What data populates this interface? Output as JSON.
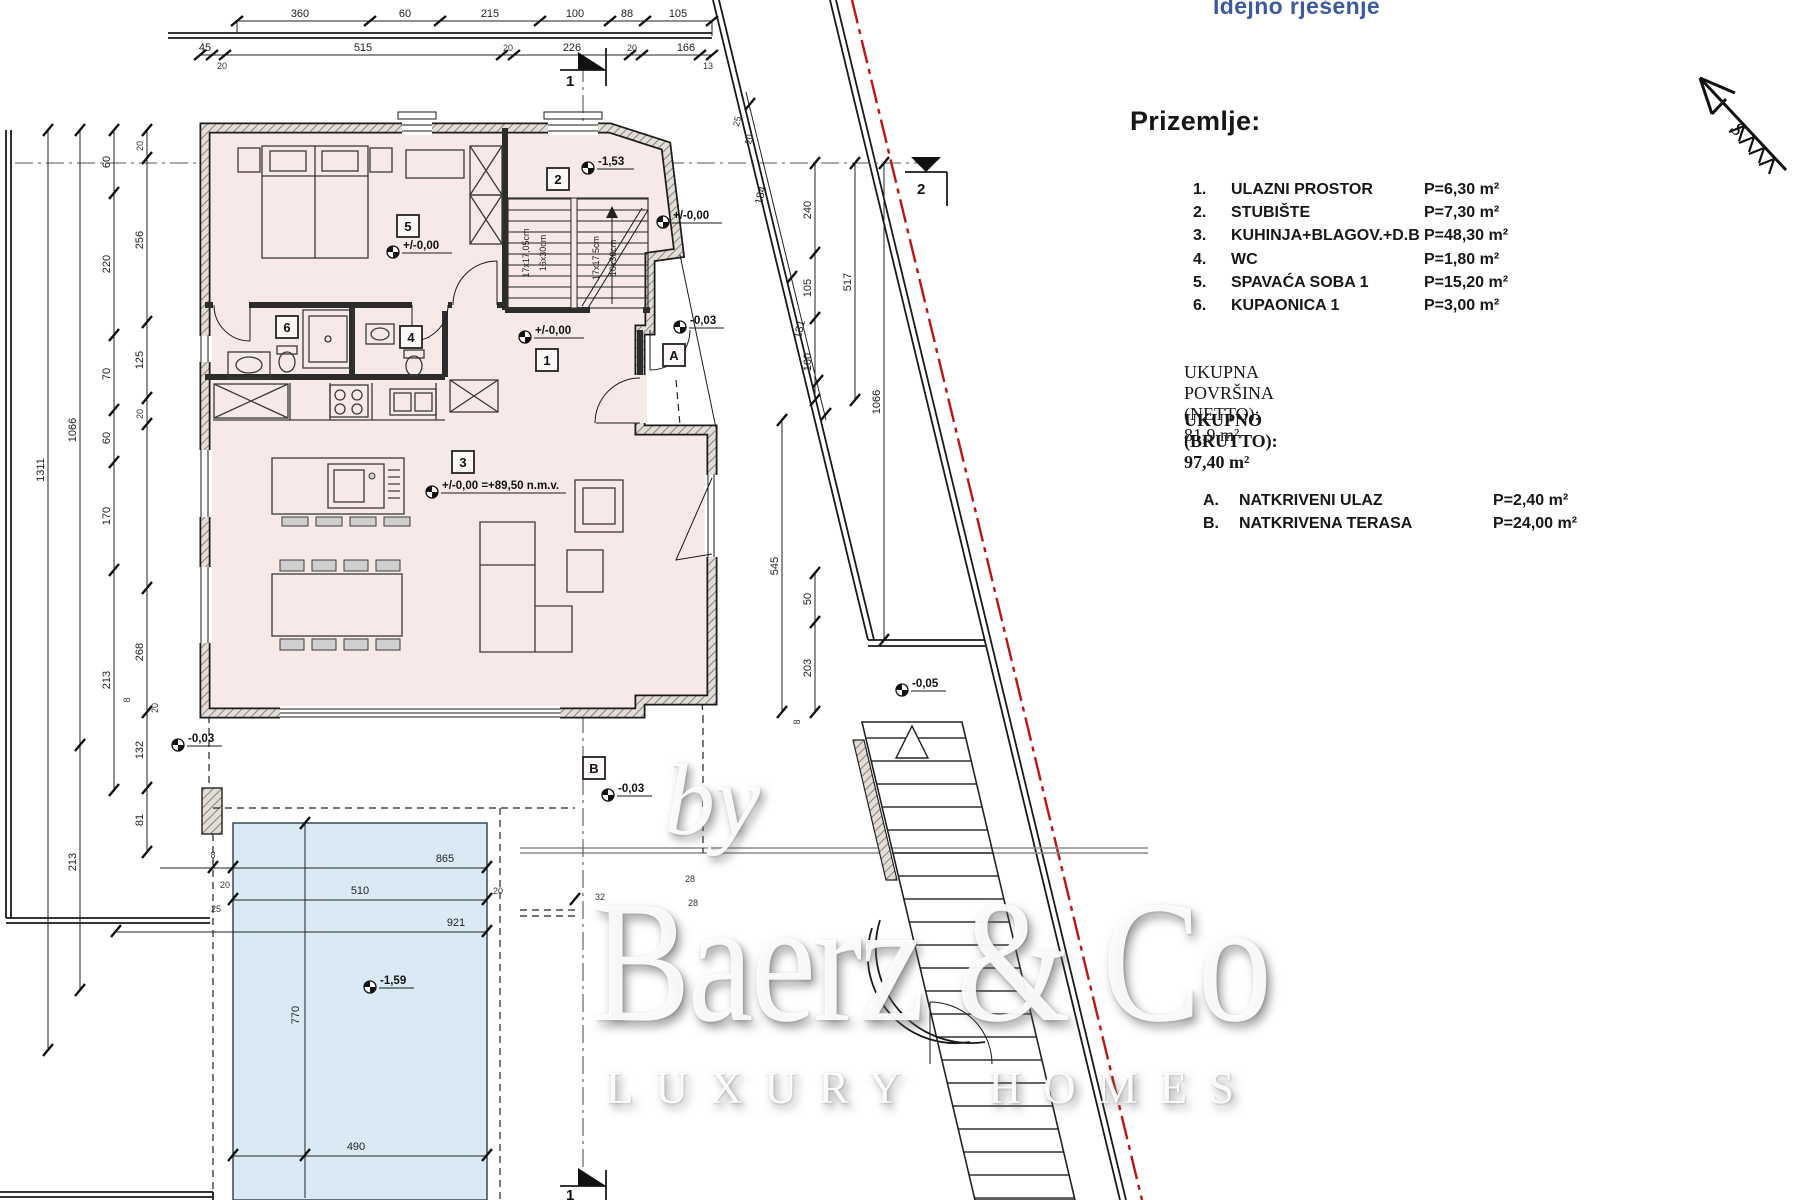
{
  "header": {
    "doc_type_label": "Idejno rješenje",
    "doc_type_color": "#3c5b9e"
  },
  "legend": {
    "heading": "Prizemlje:",
    "rooms": [
      {
        "num": "1.",
        "name": "ULAZNI PROSTOR",
        "area": "P=6,30 m²"
      },
      {
        "num": "2.",
        "name": "STUBIŠTE",
        "area": "P=7,30 m²"
      },
      {
        "num": "3.",
        "name": "KUHINJA+BLAGOV.+D.B",
        "area": "P=48,30 m²"
      },
      {
        "num": "4.",
        "name": "WC",
        "area": "P=1,80 m²"
      },
      {
        "num": "5.",
        "name": "SPAVAĆA SOBA 1",
        "area": "P=15,20 m²"
      },
      {
        "num": "6.",
        "name": "KUPAONICA 1",
        "area": "P=3,00 m²"
      }
    ],
    "total_netto": "UKUPNA POVRŠINA (NETTO): 81,9 m²",
    "total_brutto": "UKUPNO (BRUTTO): 97,40 m²",
    "annexes": [
      {
        "num": "A.",
        "name": "NATKRIVENI ULAZ",
        "area": "P=2,40 m²"
      },
      {
        "num": "B.",
        "name": "NATKRIVENA TERASA",
        "area": "P=24,00 m²"
      }
    ]
  },
  "watermark": {
    "by": "by",
    "brand": "Baerz & Co",
    "tagline": "LUXURY HOMES"
  },
  "plan": {
    "north_label": "S",
    "accent_red": "#c01414",
    "room_fill": "#f8e9e9",
    "pool_fill": "#d9eaf4",
    "section_marks": {
      "top": "1",
      "bottom": "1",
      "right": "2"
    },
    "rooms": {
      "r1": "1",
      "r2": "2",
      "r3": "3",
      "r4": "4",
      "r5": "5",
      "r6": "6"
    },
    "zones": {
      "a": "A",
      "b": "B"
    },
    "stair_notes": {
      "l1": "17x17,05cm",
      "l2": "16x30cm",
      "r1": "17x17,5cm",
      "r2": "16x30cm"
    },
    "elevations": {
      "hall": "+/-0,00",
      "stair": "-1,53",
      "entry_top": "+/-0,00",
      "entry": "+/-0,00",
      "porch": "-0,03",
      "living": "+/-0,00 =+89,50 n.m.v.",
      "west": "-0,03",
      "stair_ext": "-0,05",
      "terrace": "-0,03",
      "pool": "-1,59"
    },
    "dims": {
      "top1": [
        "360",
        "60",
        "215",
        "100",
        "88",
        "105"
      ],
      "top2": [
        "45",
        "20",
        "515",
        "20",
        "226",
        "20",
        "166",
        "13"
      ],
      "left": {
        "c1": "1311",
        "c2a": "1066",
        "c2b": "213",
        "c3": [
          "60",
          "220",
          "70",
          "60",
          "170",
          "213"
        ],
        "c4": [
          "20",
          "256",
          "125",
          "20",
          "268",
          "132",
          "81"
        ],
        "c4s": [
          "8",
          "20"
        ]
      },
      "diag": {
        "d1": "184",
        "d2": "131",
        "s1": "25",
        "s2": "20"
      },
      "right": {
        "c1": [
          "240",
          "105",
          "160"
        ],
        "c1b": [
          "50",
          "203"
        ],
        "c2": "545",
        "c3": "517",
        "c4": "1066",
        "t8": "8"
      },
      "pool": {
        "w1": "865",
        "w2": "510",
        "w3": "921",
        "h": "770",
        "b": "490",
        "s": [
          "8",
          "20",
          "25",
          "20",
          "32",
          "28",
          "28"
        ]
      }
    }
  }
}
